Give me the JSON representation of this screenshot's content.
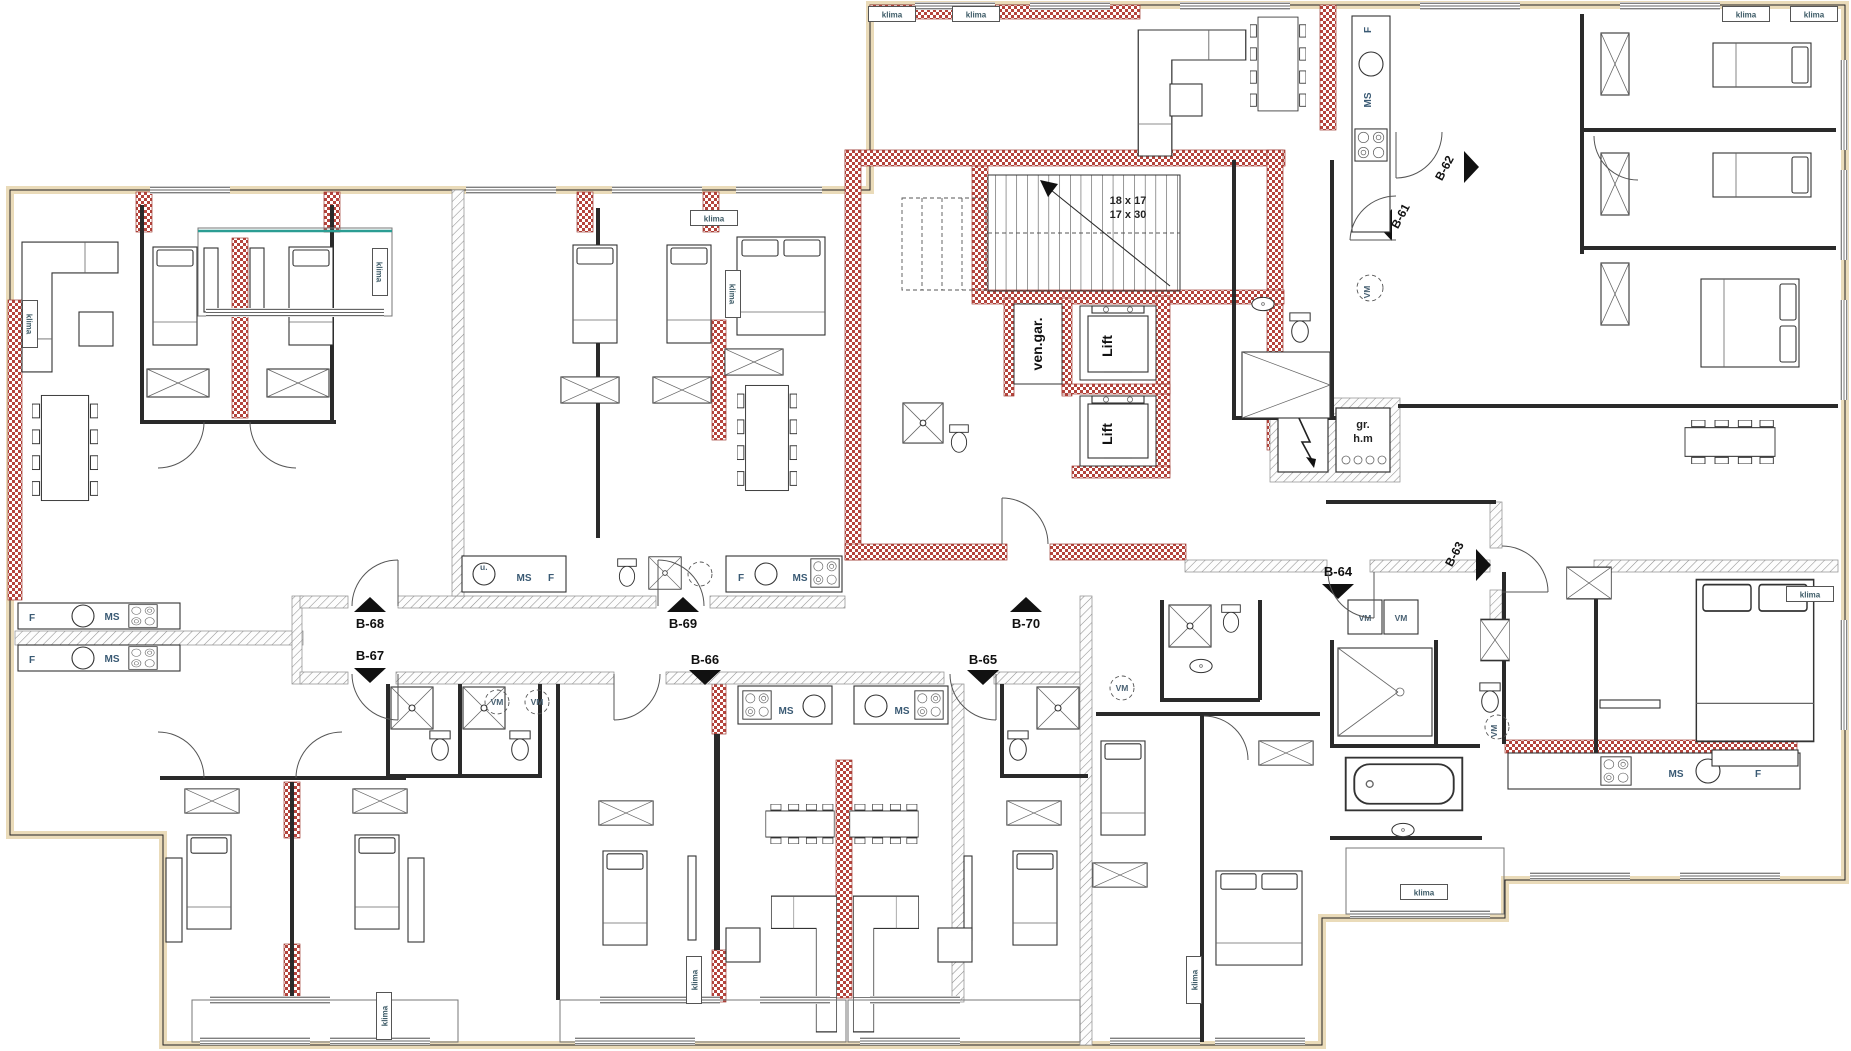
{
  "drawing": {
    "type": "architectural floor plan",
    "units": [
      {
        "id": "B-61"
      },
      {
        "id": "B-62"
      },
      {
        "id": "B-63"
      },
      {
        "id": "B-64"
      },
      {
        "id": "B-65"
      },
      {
        "id": "B-66"
      },
      {
        "id": "B-67"
      },
      {
        "id": "B-68"
      },
      {
        "id": "B-69"
      },
      {
        "id": "B-70"
      }
    ],
    "core": {
      "lift_label": "Lift",
      "vent_shaft_label": "ven.gar.",
      "meter_room_line1": "gr.",
      "meter_room_line2": "h.m",
      "stair_dim_1": "18 x 17",
      "stair_dim_2": "17 x 30"
    },
    "equipment_labels": {
      "klima": "klima",
      "dishwasher_ms": "MS",
      "fridge_f": "F",
      "washing_machine_vm": "VM",
      "sink_u": "u."
    },
    "colors": {
      "structural_wall_red": "#b5443c",
      "partition_hatch_gray": "#8f8f8f",
      "insulation_tan": "#eadbb9",
      "facade_teal": "#2b9d93",
      "linework": "#2a2a2a"
    }
  }
}
